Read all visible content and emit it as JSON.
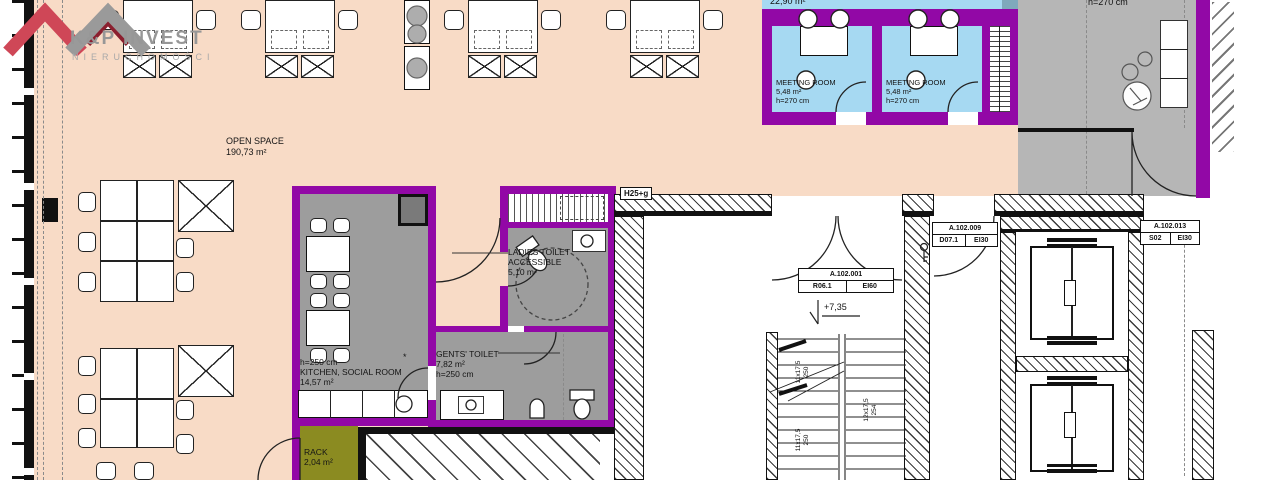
{
  "logo": {
    "title": "K&P INVEST",
    "subtitle": "NIERUCHOMOŚCI"
  },
  "rooms": {
    "open_space": {
      "name": "OPEN SPACE",
      "area": "190,73 m²"
    },
    "meeting_room_1": {
      "name": "MEETING ROOM",
      "area": "5,48 m²",
      "height": "h=270 cm"
    },
    "meeting_room_2": {
      "name": "MEETING ROOM",
      "area": "5,48 m²",
      "height": "h=270 cm"
    },
    "room_above_partial": {
      "area": "22,90 m²"
    },
    "hall_partial": {
      "height": "h=270 cm"
    },
    "kitchen": {
      "height": "h=250 cm",
      "name": "KITCHEN, SOCIAL ROOM",
      "area": "14,57 m²"
    },
    "ladies_toilet": {
      "name": "LADIES TOILET",
      "qualifier": "ACCESSIBLE",
      "area": "5,10 m²"
    },
    "gents_toilet": {
      "name": "GENTS' TOILET",
      "area": "7,82 m²",
      "height": "h=250 cm"
    },
    "rack": {
      "name": "RACK",
      "area": "2,04 m²"
    }
  },
  "annotations": {
    "lintel": "H25+g",
    "level": "+7,35",
    "asterisk": "*",
    "stairs": {
      "flight1_steps": "11x17,5",
      "flight1_run": "250",
      "flight2_steps": "11x17,5",
      "flight2_run": "250",
      "flight3_steps": "12x17,5",
      "flight3_run": "254"
    },
    "door_stair": {
      "code": "A.102.001",
      "ref": "R06.1",
      "fire": "EI60"
    },
    "door_lobby": {
      "code": "A.102.009",
      "ref": "D07.1",
      "fire": "EI30"
    },
    "door_shaft": {
      "code": "A.102.013",
      "ref": "S02",
      "fire": "EI30"
    }
  },
  "colors": {
    "peach": "#f8dbc6",
    "purple": "#9208a6",
    "blue": "#a6d9f2",
    "hallgray": "#b6b6b6",
    "roomgray": "#9d9d9d",
    "olive": "#8b8b21",
    "teal": "#7fa9bc",
    "logored": "#cf4757",
    "logogray": "#9a9a9a"
  }
}
